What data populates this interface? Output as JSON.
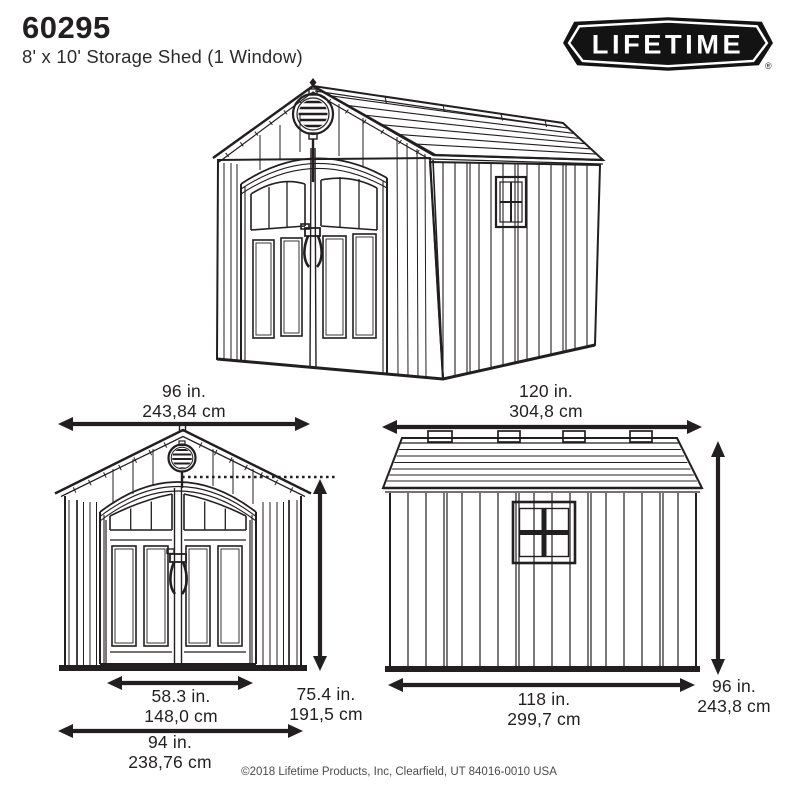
{
  "header": {
    "model": "60295",
    "subtitle": "8' x 10' Storage Shed (1 Window)"
  },
  "logo": {
    "brand": "LIFETIME",
    "registered": "®"
  },
  "dimensions": {
    "front_width": {
      "imperial": "96 in.",
      "metric": "243,84 cm"
    },
    "side_length": {
      "imperial": "120 in.",
      "metric": "304,8 cm"
    },
    "door_opening_width": {
      "imperial": "58.3 in.",
      "metric": "148,0 cm"
    },
    "door_opening_height": {
      "imperial": "75.4 in.",
      "metric": "191,5 cm"
    },
    "front_base_width": {
      "imperial": "94 in.",
      "metric": "238,76 cm"
    },
    "side_base_length": {
      "imperial": "118 in.",
      "metric": "299,7 cm"
    },
    "overall_height": {
      "imperial": "96 in.",
      "metric": "243,8 cm"
    }
  },
  "footer": {
    "copyright": "©2018 Lifetime Products, Inc, Clearfield, UT 84016-0010 USA"
  },
  "colors": {
    "line": "#231f20",
    "text": "#232323",
    "logo_bg": "#131313",
    "background": "#ffffff"
  }
}
